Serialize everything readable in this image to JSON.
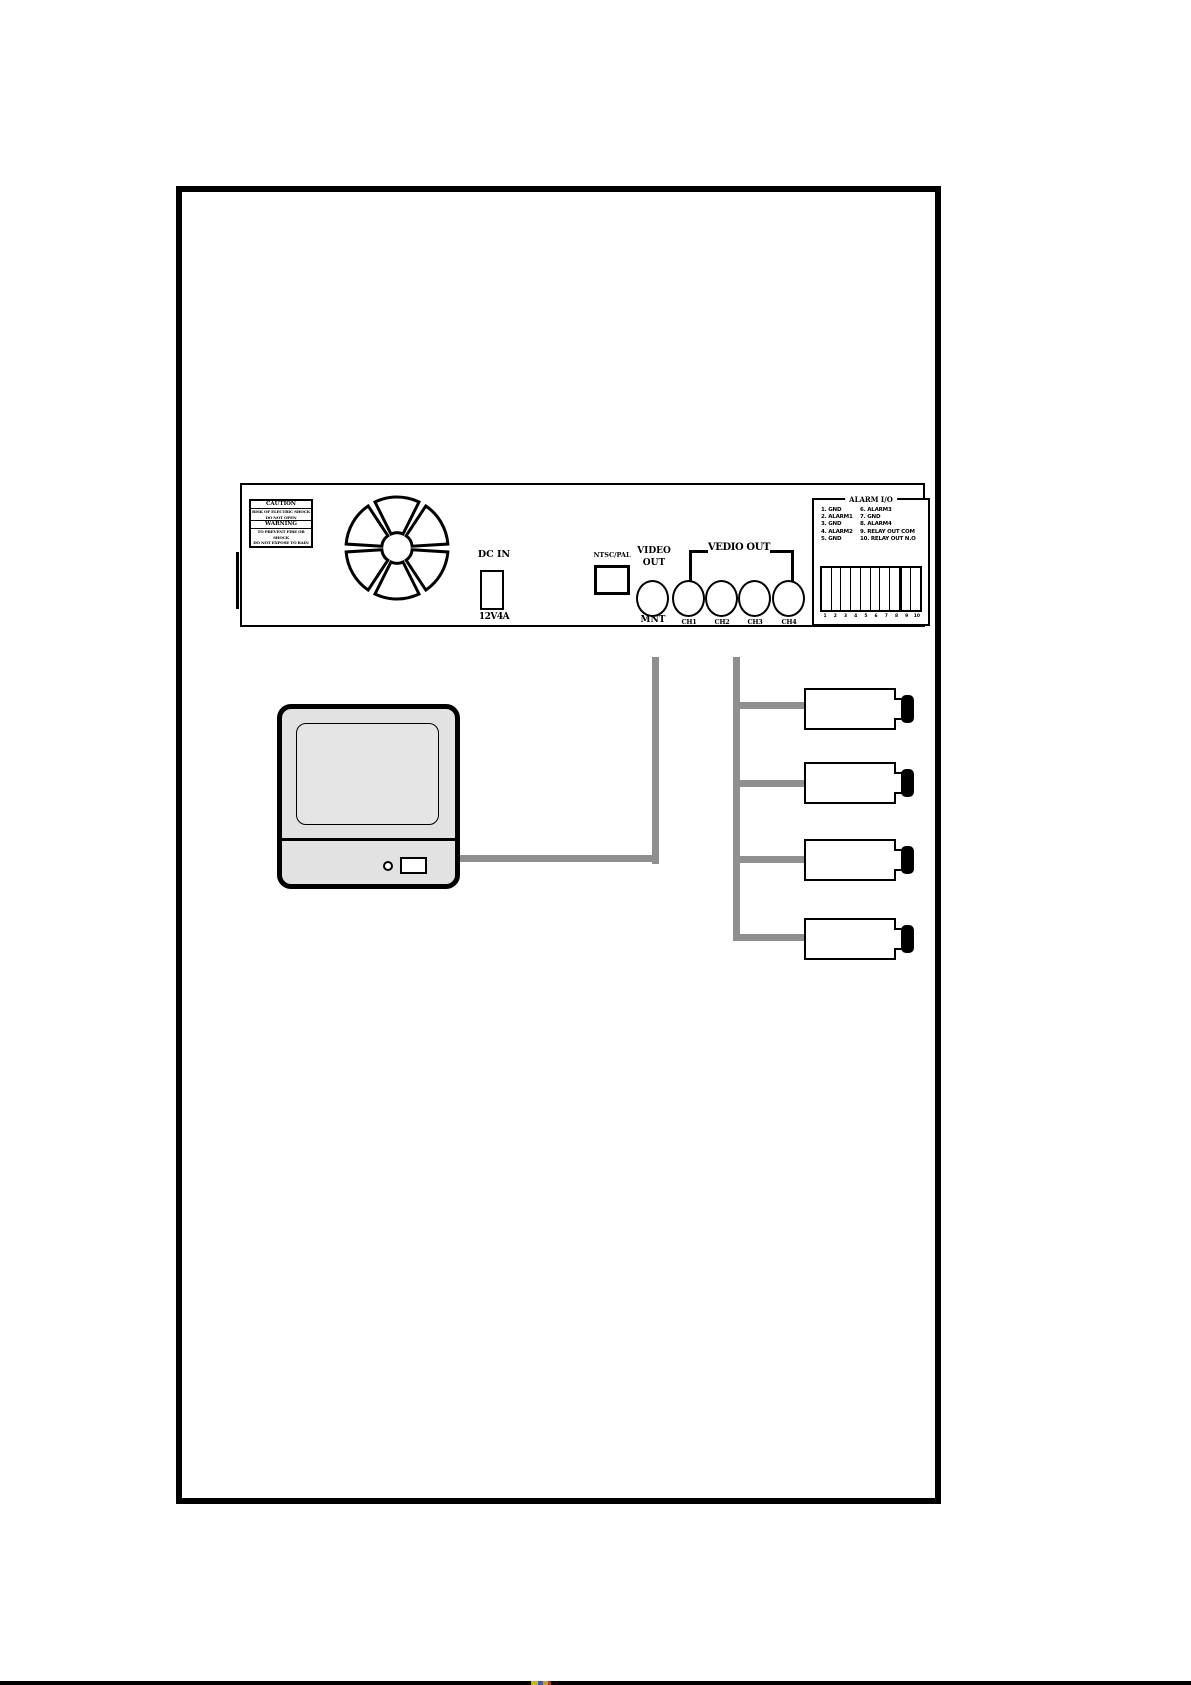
{
  "panel": {
    "caution_label": {
      "title": "CAUTION",
      "line1": "RISK OF ELECTRIC SHOCK",
      "line2": "DO NOT OPEN",
      "warning_title": "WARNING",
      "line3": "TO PREVENT FIRE OR SHOCK",
      "line4": "DO NOT EXPOSE TO RAIN"
    },
    "dc_in": {
      "label": "DC IN",
      "rating": "12V4A"
    },
    "ntsc_pal_label": "NTSC/PAL",
    "video_out_label_line1": "VIDEO",
    "video_out_label_line2": "OUT",
    "vedio_out_group_label": "VEDIO OUT",
    "connectors": {
      "monitor_label": "MNT",
      "channels": [
        "CH1",
        "CH2",
        "CH3",
        "CH4"
      ]
    },
    "alarm_io": {
      "title": "ALARM I/O",
      "pins_left": [
        "1. GND",
        "2. ALARM1",
        "3. GND",
        "4. ALARM2",
        "5. GND"
      ],
      "pins_right": [
        "6. ALARM3",
        "7. GND",
        "8. ALARM4",
        "9. RELAY OUT COM",
        "10. RELAY OUT N.O"
      ],
      "terminal_numbers": [
        "1",
        "2",
        "3",
        "4",
        "5",
        "6",
        "7",
        "8",
        "9",
        "10"
      ]
    }
  },
  "colors": {
    "cable_gray": "#8f8f8f",
    "device_fill": "#e2e2e2",
    "line_black": "#000000",
    "strip_yellow": "#c8b428",
    "strip_blue": "#4050c0",
    "strip_red": "#c03030"
  }
}
